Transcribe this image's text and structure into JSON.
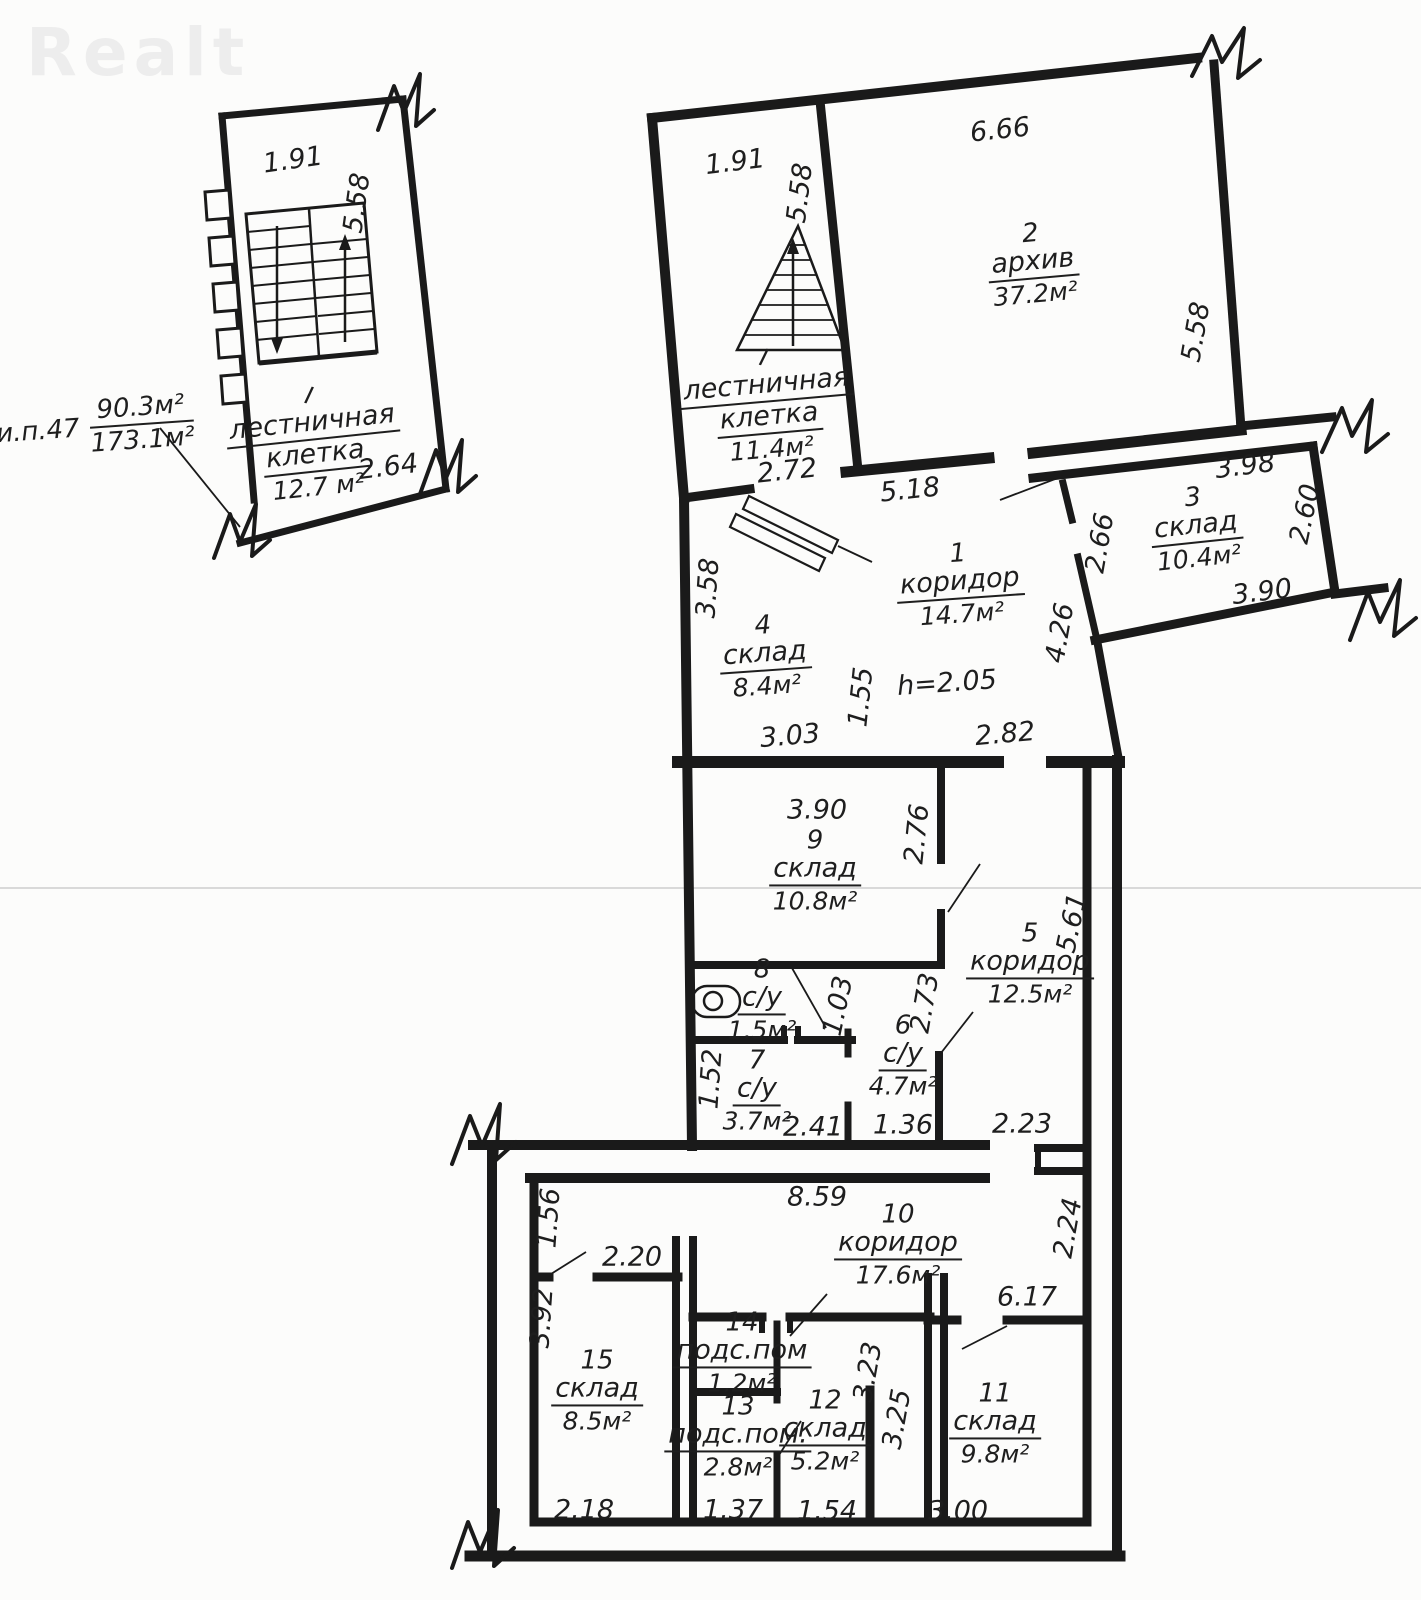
{
  "watermark": "Realt",
  "note": {
    "prefix": "и.п.47",
    "upper": "90.3м²",
    "lower": "173.1м²"
  },
  "small_plan": {
    "tick": "I",
    "name1": "лестничная",
    "name2": "клетка",
    "area": "12.7 м²",
    "dim_top": "1.91",
    "dim_side": "5.58",
    "dim_bottom": "2.64"
  },
  "rooms": {
    "stair": {
      "tick": "I",
      "name1": "лестничная",
      "name2": "клетка",
      "area": "11.4м²"
    },
    "r1": {
      "num": "1",
      "name": "коридор",
      "area": "14.7м²"
    },
    "r2": {
      "num": "2",
      "name": "архив",
      "area": "37.2м²"
    },
    "r3": {
      "num": "3",
      "name": "склад",
      "area": "10.4м²"
    },
    "r4": {
      "num": "4",
      "name": "склад",
      "area": "8.4м²"
    },
    "r5": {
      "num": "5",
      "name": "коридор",
      "area": "12.5м²"
    },
    "r6": {
      "num": "6",
      "name": "с/у",
      "area": "4.7м²"
    },
    "r7": {
      "num": "7",
      "name": "с/у",
      "area": "3.7м²"
    },
    "r8": {
      "num": "8",
      "name": "с/у",
      "area": "1.5м²"
    },
    "r9": {
      "num": "9",
      "name": "склад",
      "area": "10.8м²"
    },
    "r10": {
      "num": "10",
      "name": "коридор",
      "area": "17.6м²"
    },
    "r11": {
      "num": "11",
      "name": "склад",
      "area": "9.8м²"
    },
    "r12": {
      "num": "12",
      "name": "склад",
      "area": "5.2м²"
    },
    "r13": {
      "num": "13",
      "name": "подс.пом.",
      "area": "2.8м²"
    },
    "r14": {
      "num": "14",
      "name": "подс.пом",
      "area": "1.2м²"
    },
    "r15": {
      "num": "15",
      "name": "склад",
      "area": "8.5м²"
    }
  },
  "dims": {
    "m191": "1.91",
    "m558_stair": "5.58",
    "m272": "2.72",
    "m666": "6.66",
    "m558_arch": "5.58",
    "m518": "5.18",
    "m398": "3.98",
    "m260": "2.60",
    "m390_s3": "3.90",
    "m266": "2.66",
    "m426": "4.26",
    "m358": "3.58",
    "m155": "1.55",
    "m303": "3.03",
    "m282": "2.82",
    "h205": "h=2.05",
    "m390_s9": "3.90",
    "m276": "2.76",
    "m561": "5.61",
    "m103": "1.03",
    "m273": "2.73",
    "m152": "1.52",
    "m241": "2.41",
    "m136": "1.36",
    "m223": "2.23",
    "m859": "8.59",
    "m156": "1.56",
    "m220": "2.20",
    "m392": "3.92",
    "m224": "2.24",
    "m617": "6.17",
    "m323": "3.23",
    "m325": "3.25",
    "m218": "2.18",
    "m137": "1.37",
    "m154": "1.54",
    "m300": "3.00"
  }
}
